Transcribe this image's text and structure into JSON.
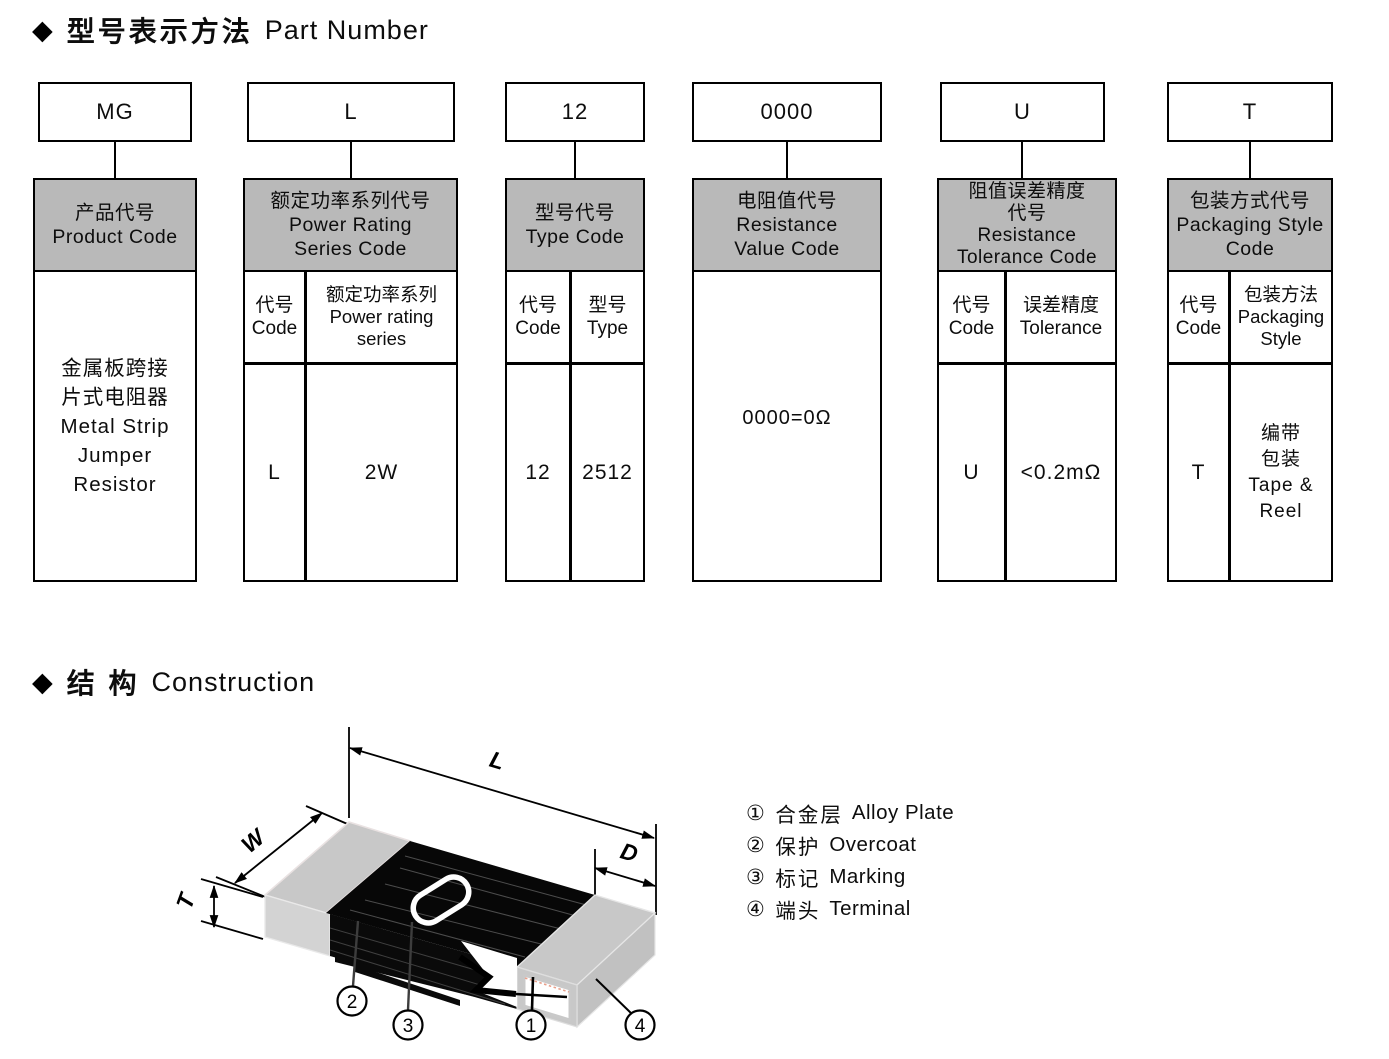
{
  "page": {
    "background": "#ffffff",
    "header_gray": "#b9b9b9"
  },
  "part_number": {
    "bullet": "◆",
    "title_zh": "型号表示方法",
    "title_en": "Part Number",
    "columns": [
      {
        "code": "MG",
        "header": "产品代号\nProduct Code",
        "body": "金属板跨接\n片式电阻器\nMetal Strip\nJumper\nResistor"
      },
      {
        "code": "L",
        "header": "额定功率系列代号\nPower Rating\nSeries Code",
        "sub_code": "代号\nCode",
        "sub_desc": "额定功率系列\nPower rating\nseries",
        "val_code": "L",
        "val_desc": "2W"
      },
      {
        "code": "12",
        "header": "型号代号\nType Code",
        "sub_code": "代号\nCode",
        "sub_desc": "型号\nType",
        "val_code": "12",
        "val_desc": "2512"
      },
      {
        "code": "0000",
        "header": "电阻值代号\nResistance\nValue Code",
        "body": "0000=0Ω"
      },
      {
        "code": "U",
        "header": "阻值误差精度\n代号\nResistance\nTolerance Code",
        "sub_code": "代号\nCode",
        "sub_desc": "误差精度\nTolerance",
        "val_code": "U",
        "val_desc": "<0.2mΩ"
      },
      {
        "code": "T",
        "header": "包装方式代号\nPackaging Style\nCode",
        "sub_code": "代号\nCode",
        "sub_desc": "包装方法\nPackaging\nStyle",
        "val_code": "T",
        "val_desc": "编带\n包装\nTape &\nReel"
      }
    ]
  },
  "construction": {
    "bullet": "◆",
    "title_zh": "结 构",
    "title_en": "Construction",
    "dims": {
      "l": "L",
      "w": "W",
      "t": "T",
      "d": "D"
    },
    "callouts": {
      "alloy": "1",
      "overcoat": "2",
      "marking": "3",
      "terminal": "4"
    },
    "legend": [
      {
        "marker": "①",
        "zh": "合金层",
        "en": "Alloy Plate"
      },
      {
        "marker": "②",
        "zh": "保护",
        "en": "Overcoat"
      },
      {
        "marker": "③",
        "zh": "标记",
        "en": "Marking"
      },
      {
        "marker": "④",
        "zh": "端头",
        "en": "Terminal"
      }
    ]
  }
}
